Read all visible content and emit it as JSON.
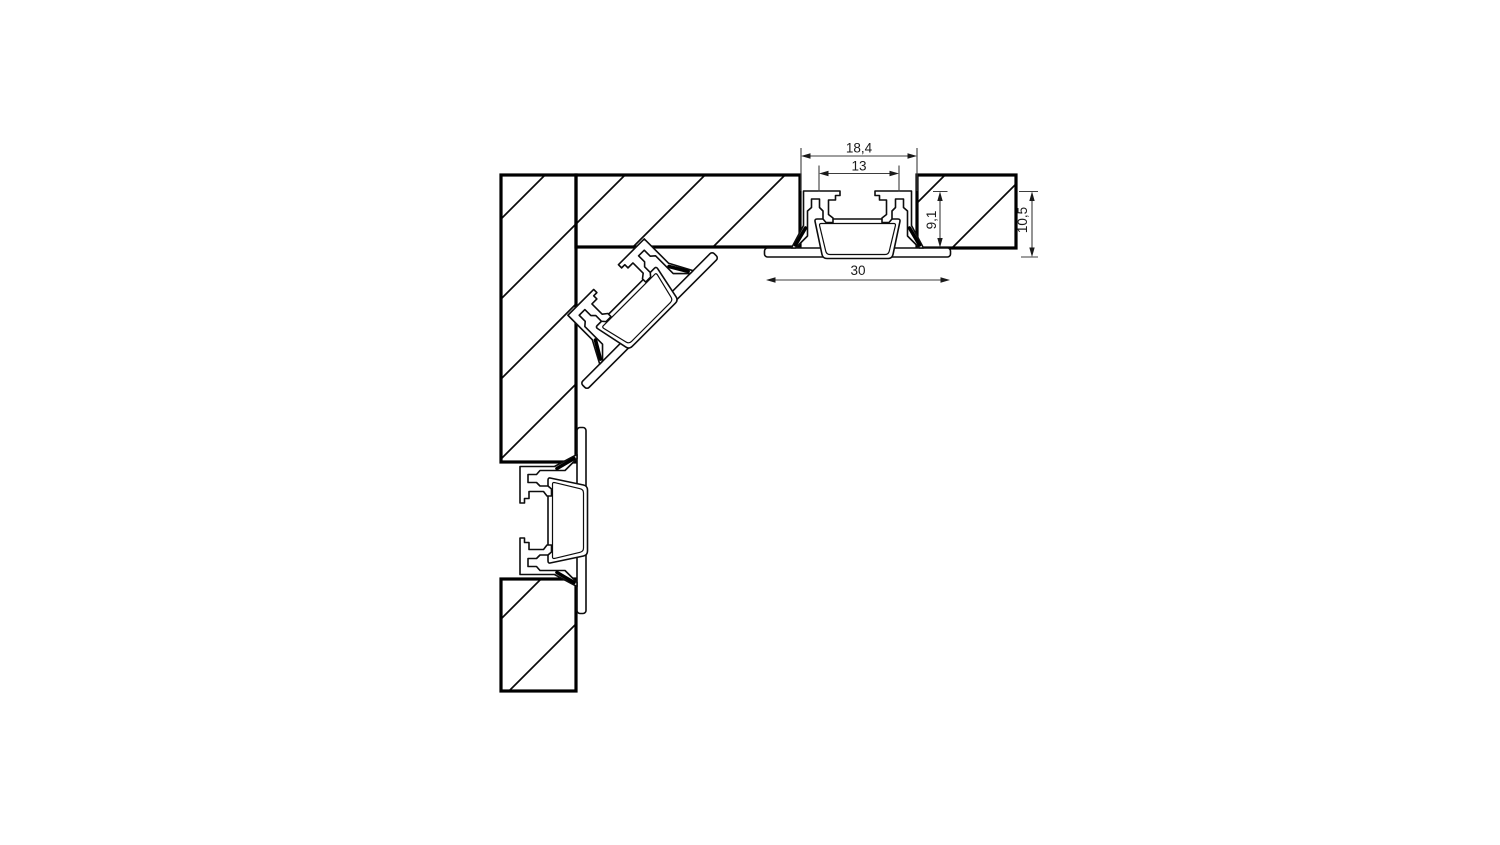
{
  "diagram": {
    "description": "recessed-led-profile-corner-installation-cross-section",
    "dimension_labels": {
      "opening_width": "18,4",
      "inner_width": "13",
      "recess_depth": "9,1",
      "total_height": "10,5",
      "flange_width": "30"
    },
    "colors": {
      "background": "#ffffff",
      "drawing_line": "#0d0d0d",
      "panel_border": "#000000",
      "dimension_line": "#3d3d3d",
      "label_text": "#1a1a1a",
      "profile_fill": "#ffffff"
    }
  }
}
